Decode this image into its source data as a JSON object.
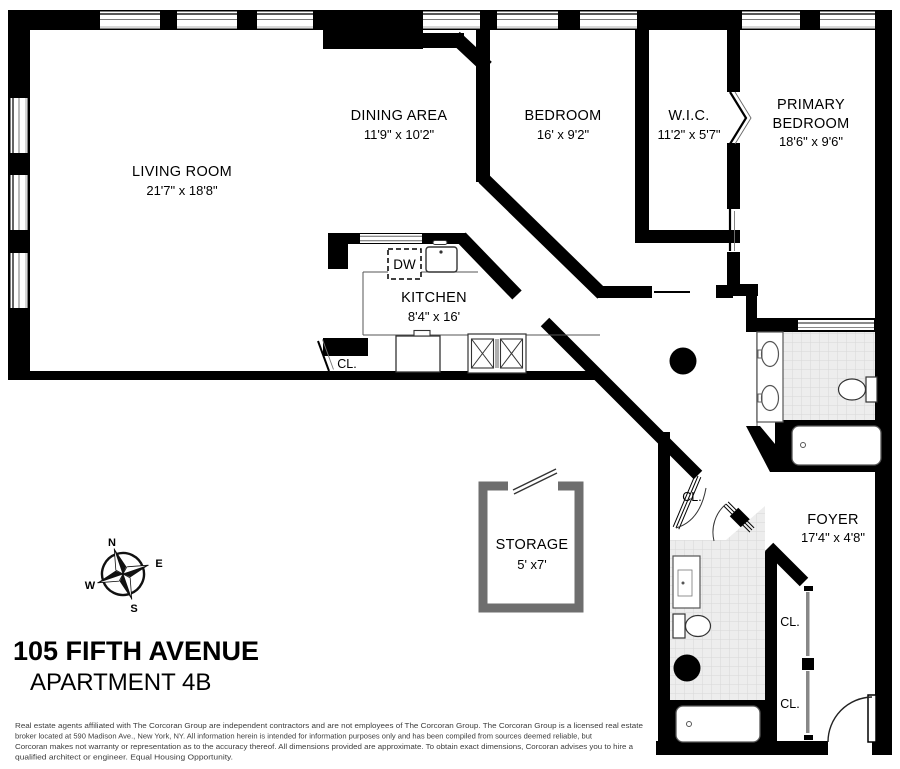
{
  "title": {
    "building": "105 FIFTH AVENUE",
    "unit": "APARTMENT 4B"
  },
  "rooms": {
    "living": {
      "name": "LIVING ROOM",
      "dims": "21'7\" x 18'8\""
    },
    "dining": {
      "name": "DINING AREA",
      "dims": "11'9\" x 10'2\""
    },
    "bedroom": {
      "name": "BEDROOM",
      "dims": "16' x 9'2\""
    },
    "wic": {
      "name": "W.I.C.",
      "dims": "11'2\" x 5'7\""
    },
    "primary": {
      "name_line1": "PRIMARY",
      "name_line2": "BEDROOM",
      "dims": "18'6\" x 9'6\""
    },
    "kitchen": {
      "name": "KITCHEN",
      "dims": "8'4\" x 16'"
    },
    "storage": {
      "name": "STORAGE",
      "dims": "5' x7'"
    },
    "foyer": {
      "name": "FOYER",
      "dims": "17'4\" x 4'8\""
    }
  },
  "labels": {
    "closet": "CL.",
    "dishwasher": "DW"
  },
  "compass": {
    "north": "N",
    "east": "E",
    "south": "S",
    "west": "W"
  },
  "disclaimer": {
    "lines": [
      "Real estate agents affiliated with The Corcoran Group are independent contractors and are not employees of The Corcoran Group. The Corcoran Group is a licensed real estate",
      "broker located at 590 Madison Ave., New York, NY. All information herein is intended for information purposes only and has been compiled from sources deemed reliable, but",
      "Corcoran makes not warranty or representation as to the accuracy thereof. All dimensions provided are approximate. To obtain exact dimensions, Corcoran advises you to hire a",
      "qualified architect or engineer. Equal Housing Opportunity."
    ]
  },
  "colors": {
    "wall": "#000000",
    "tile_fill": "#ededed",
    "tile_grid": "#d8d8d8",
    "storage_outline": "#6e6e6e",
    "fixture_outline": "#555555",
    "disclaimer_text": "#3d3d3d"
  }
}
